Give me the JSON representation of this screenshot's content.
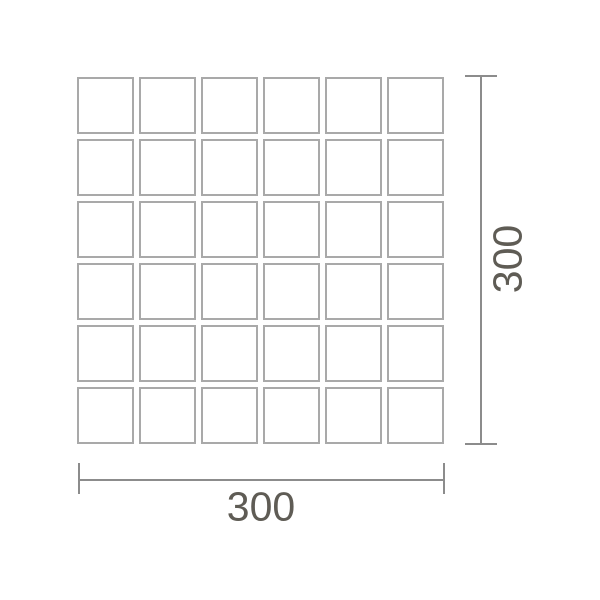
{
  "diagram": {
    "type": "mosaic-tile-dimension-diagram",
    "grid": {
      "rows": 6,
      "cols": 6,
      "tile_count": 36
    },
    "dimensions": {
      "width_label": "300",
      "height_label": "300"
    },
    "colors": {
      "background": "#ffffff",
      "tile_border": "#a9a9a9",
      "dimension_line": "#8c8c8c",
      "label_text": "#5f5c55"
    }
  }
}
